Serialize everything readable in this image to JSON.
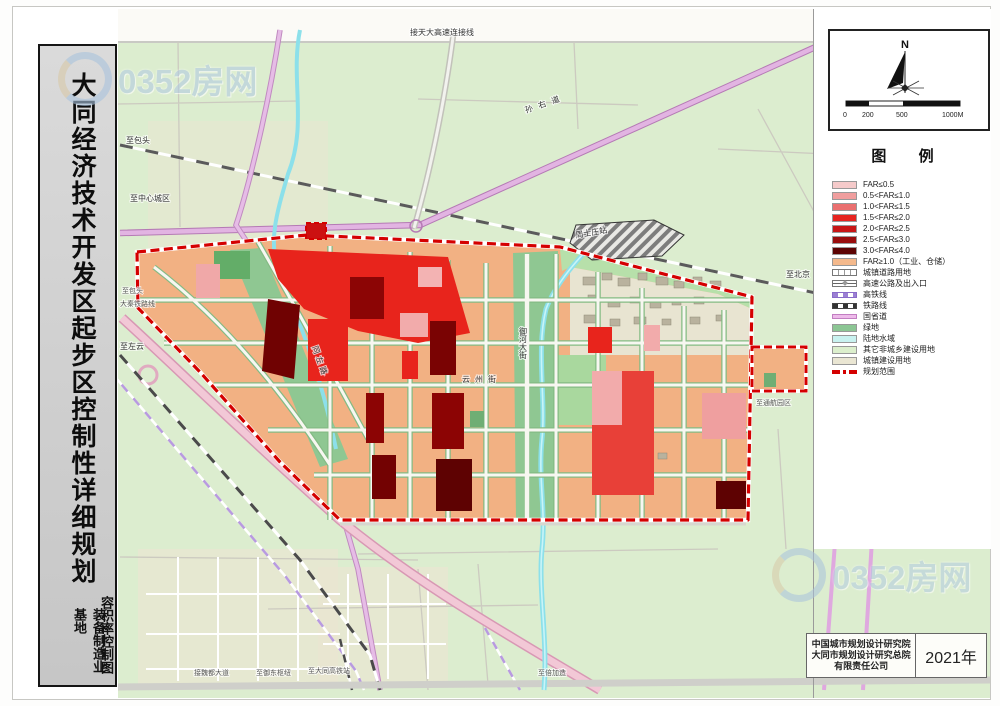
{
  "watermark": {
    "text": "0352房网"
  },
  "title_bar": {
    "main": "大同经济技术开发区起步区控制性详细规划",
    "sub_left": "装备制造业基地",
    "sub_right": "容积率控制图"
  },
  "north_panel": {
    "label": "N",
    "scale_ticks": [
      "0",
      "200",
      "500",
      "1000M"
    ]
  },
  "legend": {
    "title": "图  例",
    "items": [
      {
        "label": "FAR≤0.5",
        "color": "#f5caca"
      },
      {
        "label": "0.5<FAR≤1.0",
        "color": "#f09e9e"
      },
      {
        "label": "1.0<FAR≤1.5",
        "color": "#ea6f6f"
      },
      {
        "label": "1.5<FAR≤2.0",
        "color": "#e62420"
      },
      {
        "label": "2.0<FAR≤2.5",
        "color": "#c81616"
      },
      {
        "label": "2.5<FAR≤3.0",
        "color": "#990d0d"
      },
      {
        "label": "3.0<FAR≤4.0",
        "color": "#5c0303"
      },
      {
        "label": "FAR≥1.0（工业、仓储）",
        "color": "#f4b98c"
      },
      {
        "label": "城镇道路用地",
        "type": "road"
      },
      {
        "label": "高速公路及出入口",
        "type": "highway"
      },
      {
        "label": "高铁线",
        "type": "hsr",
        "color": "#9b7fd4"
      },
      {
        "label": "铁路线",
        "type": "rail"
      },
      {
        "label": "国省道",
        "type": "provincial",
        "color": "#eebbea"
      },
      {
        "label": "绿地",
        "color": "#8cc694"
      },
      {
        "label": "陆地水域",
        "color": "#c9f2f0"
      },
      {
        "label": "其它非城乡建设用地",
        "color": "#dcefcd"
      },
      {
        "label": "城镇建设用地",
        "color": "#eae6d3"
      },
      {
        "label": "规划范围",
        "type": "boundary",
        "color": "#d40000"
      }
    ]
  },
  "map": {
    "labels": [
      {
        "text": "接天大高速连接线"
      },
      {
        "text": "孙右道"
      },
      {
        "text": "至北京"
      },
      {
        "text": "至包头"
      },
      {
        "text": "至中心城区"
      },
      {
        "text": "至包头"
      },
      {
        "text": "大秦铁路线"
      },
      {
        "text": "至左云"
      },
      {
        "text": "周士庄站"
      },
      {
        "text": "云州街"
      },
      {
        "text": "同左路"
      },
      {
        "text": "御河大街"
      },
      {
        "text": "至通航园区"
      },
      {
        "text": "接魏都大道"
      },
      {
        "text": "至御东枢纽"
      },
      {
        "text": "至大同高铁站"
      },
      {
        "text": "至倍加造"
      }
    ]
  },
  "footer": {
    "company_lines": [
      "中国城市规划设计研究院",
      "大同市规划设计研究总院",
      "有限责任公司"
    ],
    "year": "2021年"
  }
}
